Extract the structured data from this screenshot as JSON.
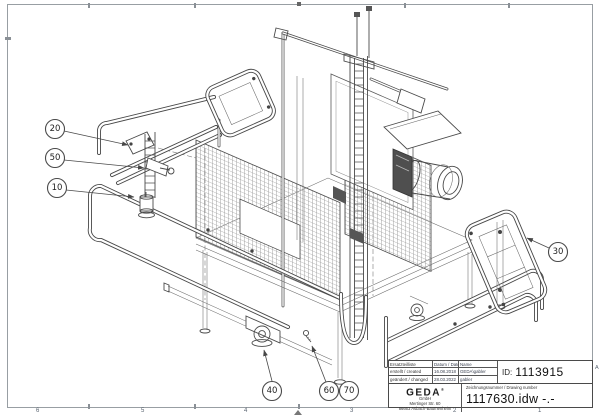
{
  "balloons": [
    "10",
    "20",
    "30",
    "40",
    "50",
    "60",
    "70"
  ],
  "zones": {
    "bottom": [
      "6",
      "5",
      "4",
      "3",
      "2",
      "1"
    ],
    "right_letter": "A"
  },
  "title_block": {
    "table": {
      "col1_header": "Ersatzteilliste",
      "col2_header": "Datum / Date",
      "col3_header": "Name",
      "rows": [
        {
          "label": "erstellt / created",
          "date": "16.08.2018",
          "name": "GEDA\\gabler"
        },
        {
          "label": "geändert / changed",
          "date": "28.03.2022",
          "name": "gabler"
        }
      ],
      "id_label": "ID:",
      "id_value": "1113915"
    },
    "company": {
      "logo": "GEDA",
      "registered_mark": "®",
      "suffix": "GmbH",
      "street": "Mertinger Str. 60",
      "city": "86663 Asbach-Bäumenheim"
    },
    "drawing": {
      "label": "Zeichnungsnummer / Drawing number",
      "number": "1117630.idw -.-"
    }
  }
}
